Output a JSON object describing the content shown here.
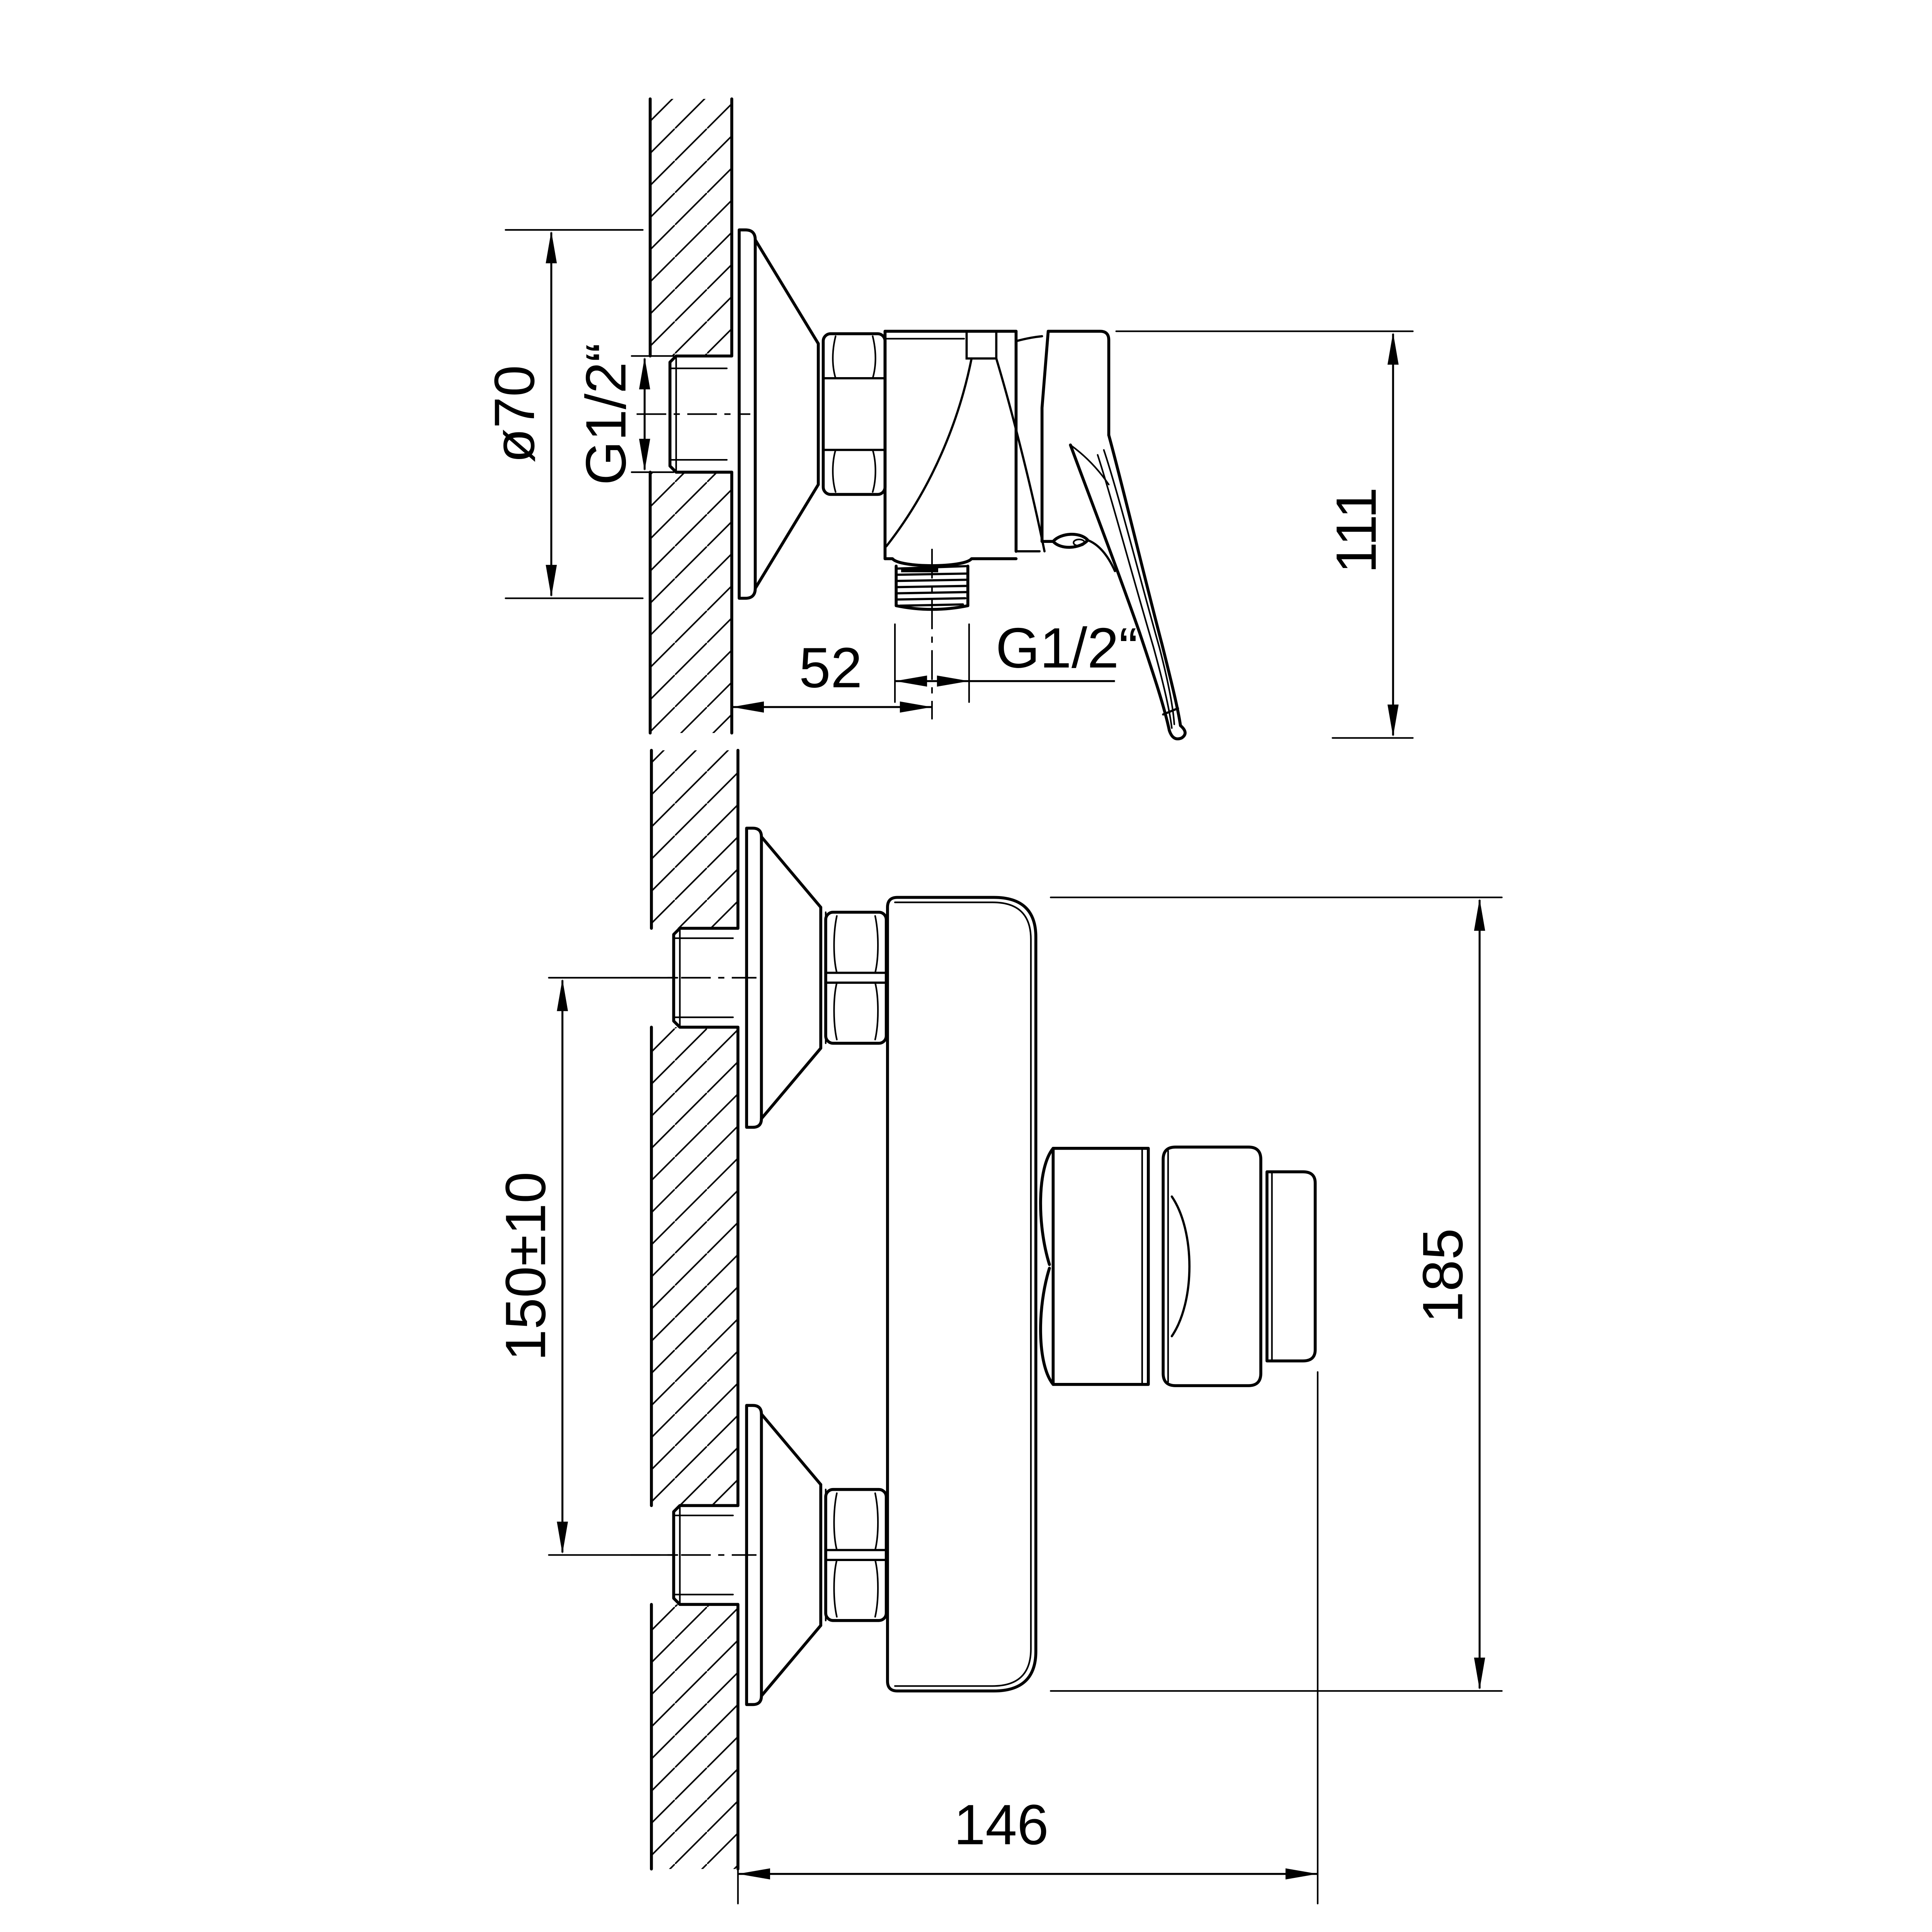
{
  "drawing": {
    "type": "technical-dimension-drawing",
    "subject": "wall-mounted single-lever shower mixer",
    "colors": {
      "line": "#000000",
      "background": "#ffffff"
    },
    "views": {
      "side_view": {
        "name": "side view (section through wall)",
        "dimensions": {
          "escutcheon_diameter": "ø70",
          "supply_thread": "G1/2“",
          "outlet_thread": "G1/2“",
          "outlet_offset_from_wall": "52",
          "overall_height": "111"
        }
      },
      "front_view": {
        "name": "plan view on wall",
        "dimensions": {
          "connection_spacing": "150±10",
          "overall_body_height": "185",
          "depth_from_wall": "146"
        }
      }
    }
  }
}
